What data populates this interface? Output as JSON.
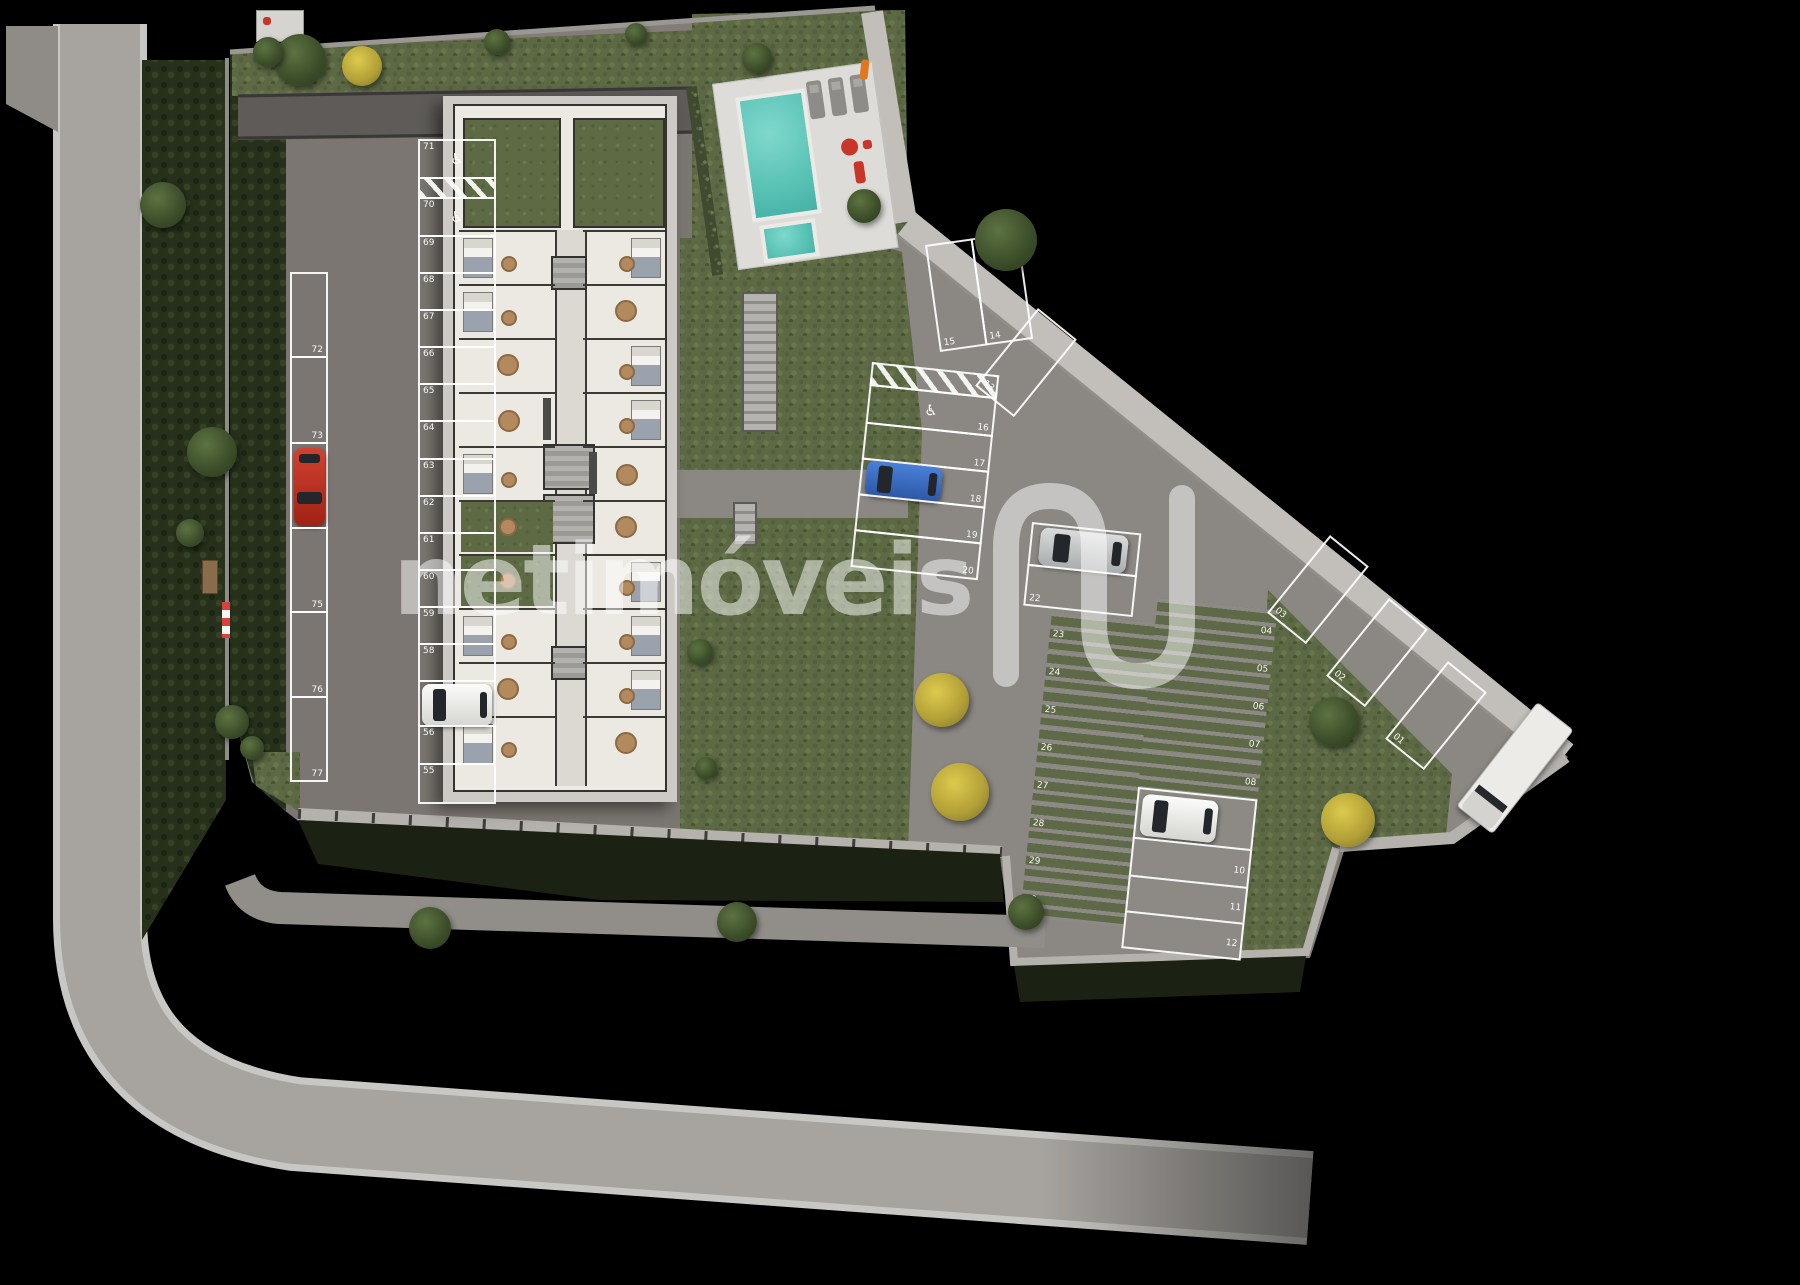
{
  "watermark": {
    "brand_text": "netimóveis",
    "logo": "N-swoosh"
  },
  "site_plan": {
    "description": "aerial 3D render of residential ground floor site plan with parking lot, apartment building floorplans, pool and gardens",
    "parking_spaces": {
      "outer_left_column": [
        {
          "label": "72"
        },
        {
          "label": "73"
        },
        {
          "label": "74",
          "occupied_by": "red-car"
        },
        {
          "label": "75"
        },
        {
          "label": "76"
        },
        {
          "label": "77"
        }
      ],
      "main_left_column": [
        {
          "label": "71",
          "handicap": true
        },
        {
          "hatched": true
        },
        {
          "label": "70",
          "handicap": true
        },
        {
          "label": "69"
        },
        {
          "label": "68"
        },
        {
          "label": "67"
        },
        {
          "label": "66"
        },
        {
          "label": "65"
        },
        {
          "label": "64"
        },
        {
          "label": "63"
        },
        {
          "label": "62"
        },
        {
          "label": "61"
        },
        {
          "label": "60"
        },
        {
          "label": "59"
        },
        {
          "label": "58"
        },
        {
          "occupied_by": "white-car"
        },
        {
          "label": "56"
        },
        {
          "label": "55"
        }
      ],
      "right_top_pair": [
        {
          "label": "15"
        },
        {
          "label": "14"
        }
      ],
      "right_diagonal_spaces": [
        {
          "label": "13"
        },
        {
          "label": "03"
        },
        {
          "label": "02"
        },
        {
          "label": "01"
        }
      ],
      "right_west_column": [
        {
          "hatched": true
        },
        {
          "label": "16",
          "handicap": true
        },
        {
          "label": "17"
        },
        {
          "label": "18",
          "occupied_by": "blue-car"
        },
        {
          "label": "19"
        },
        {
          "label": "20"
        }
      ],
      "center_pair": [
        {
          "occupied_by": "silver-car"
        },
        {
          "label": "22"
        }
      ],
      "paver_column_west": [
        {
          "label": "23"
        },
        {
          "label": "24"
        },
        {
          "label": "25"
        },
        {
          "label": "26"
        },
        {
          "label": "27"
        },
        {
          "label": "28"
        },
        {
          "label": "29"
        },
        {
          "label": "30"
        }
      ],
      "paver_column_east": [
        {
          "label": "04"
        },
        {
          "label": "05"
        },
        {
          "label": "06"
        },
        {
          "label": "07"
        },
        {
          "label": "08"
        },
        {
          "occupied_by": "white-car-2"
        },
        {
          "label": "10"
        },
        {
          "label": "11"
        },
        {
          "label": "12"
        }
      ]
    },
    "vehicles": [
      {
        "name": "red-car",
        "color": "#c23a29"
      },
      {
        "name": "white-car",
        "color": "#f0f0ee"
      },
      {
        "name": "blue-car",
        "color": "#3e6fc4"
      },
      {
        "name": "silver-car",
        "color": "#c6c8c8"
      },
      {
        "name": "white-car-2",
        "color": "#eeeeec"
      },
      {
        "name": "delivery-truck",
        "color": "#ecebe7"
      }
    ],
    "amenities": {
      "pool": "swimming-pool",
      "kids_pool": "children-pool",
      "sun_loungers": 3,
      "building": "apartment-building-floorplans",
      "stairs": "garden-stairs",
      "trees": "green-and-yellow-trees",
      "road": "perimeter-street"
    },
    "colors": {
      "background": "#000000",
      "road": "#a7a4a0",
      "pavement_left": "#7b7671",
      "pavement_right": "#8b8782",
      "lawn": "#5d6845",
      "pool_water": "#54bfb2",
      "marking_line": "#ffffff"
    }
  }
}
